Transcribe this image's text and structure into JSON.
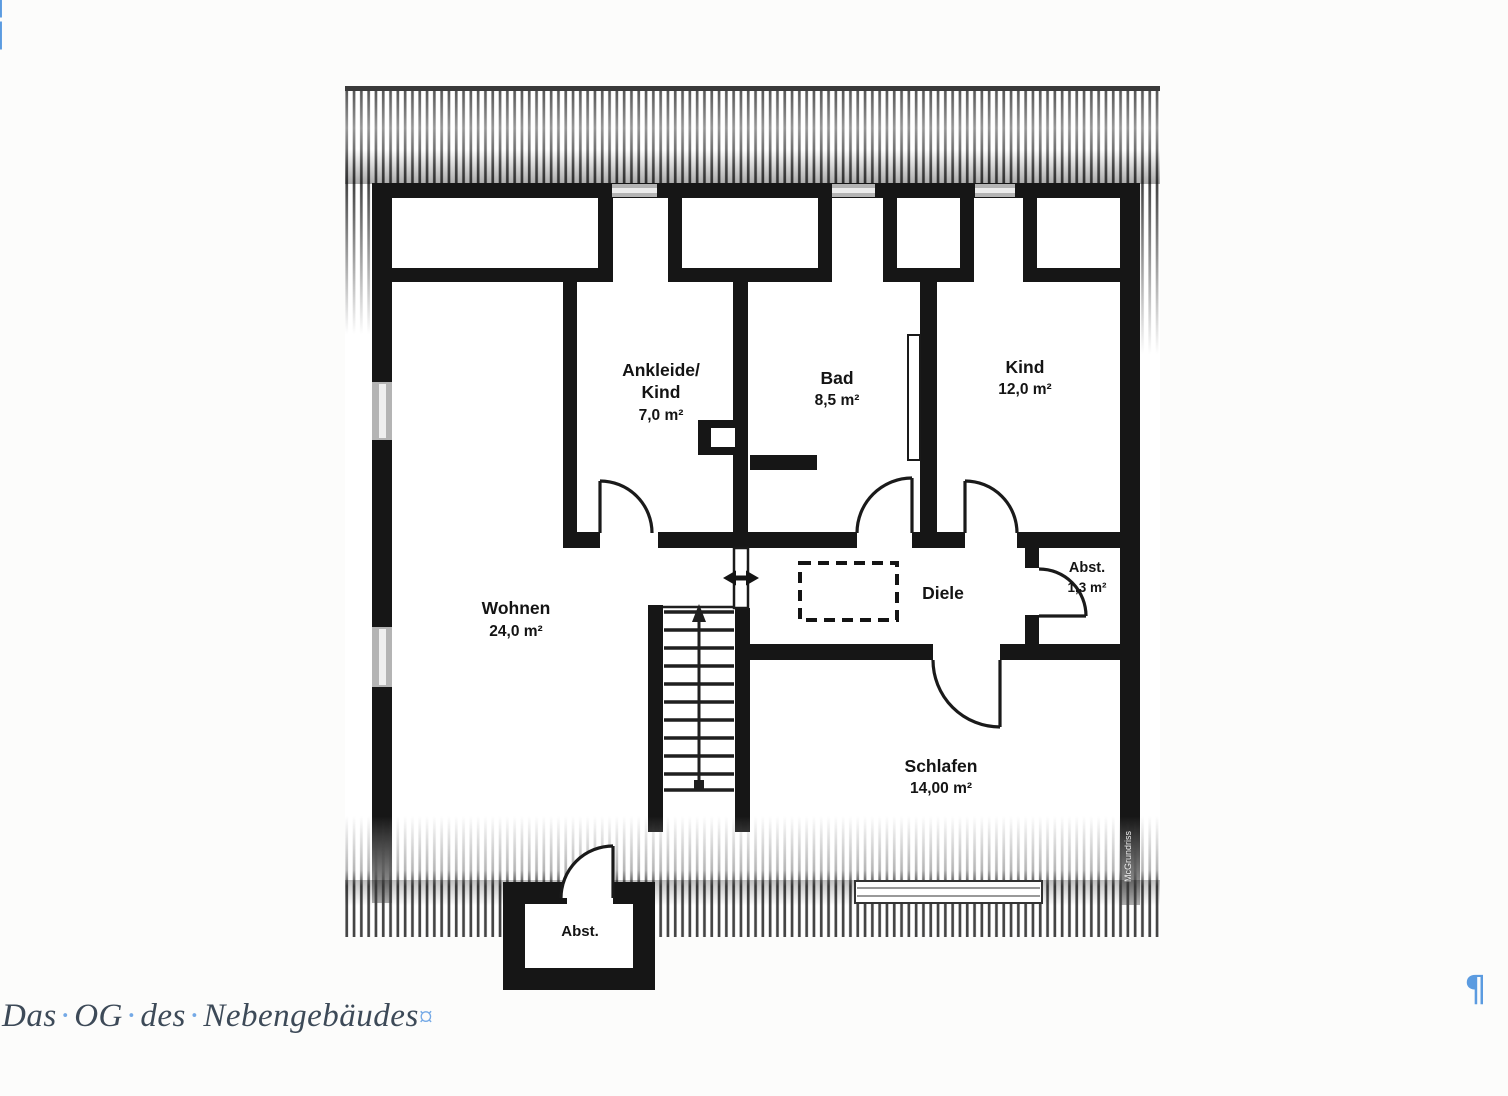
{
  "caption": {
    "word1": "Das",
    "word2": "OG",
    "word3": "des",
    "word4": "Nebengebäudes",
    "space_mark": "·",
    "end_mark": "¤",
    "text_color": "#3d4a58",
    "mark_color": "#74a9e6"
  },
  "formatting_marks": {
    "pilcrow": "¶",
    "color": "#5b9be0"
  },
  "floor_plan": {
    "watermark": "McGrundriss",
    "colors": {
      "wall": "#161616",
      "window_gray": "#b4b4b4",
      "paper": "#ffffff"
    },
    "rooms": {
      "ankleide": {
        "name_line1": "Ankleide/",
        "name_line2": "Kind",
        "area": "7,0 m²"
      },
      "bad": {
        "name": "Bad",
        "area": "8,5 m²"
      },
      "kind": {
        "name": "Kind",
        "area": "12,0 m²"
      },
      "wohnen": {
        "name": "Wohnen",
        "area": "24,0 m²"
      },
      "diele": {
        "name": "Diele"
      },
      "abstellraum": {
        "name": "Abst.",
        "area": "1,3 m²"
      },
      "schlafen": {
        "name": "Schlafen",
        "area": "14,00 m²"
      },
      "abstellraum_unten": {
        "name": "Abst."
      }
    }
  }
}
